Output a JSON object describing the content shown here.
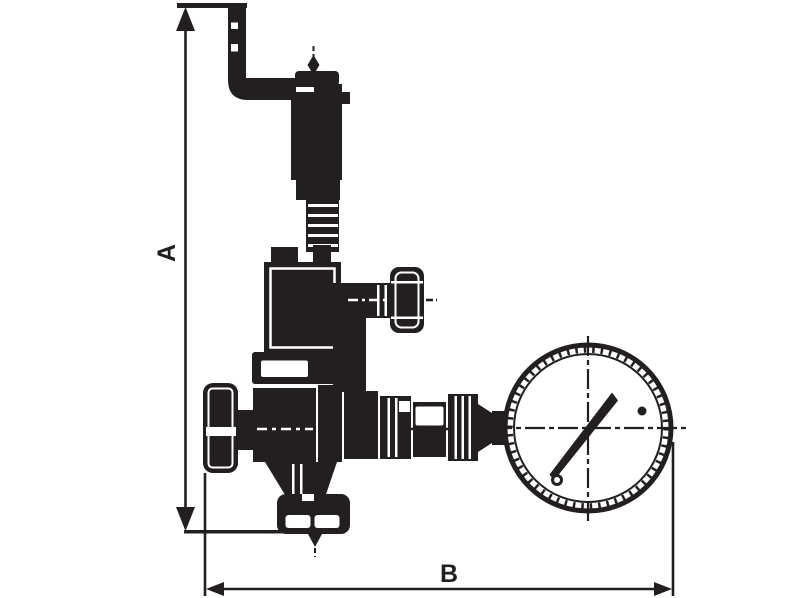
{
  "drawing": {
    "background_color": "#ffffff",
    "ink_color": "#231f20",
    "dimension_labels": {
      "vertical": "A",
      "horizontal": "B"
    }
  }
}
